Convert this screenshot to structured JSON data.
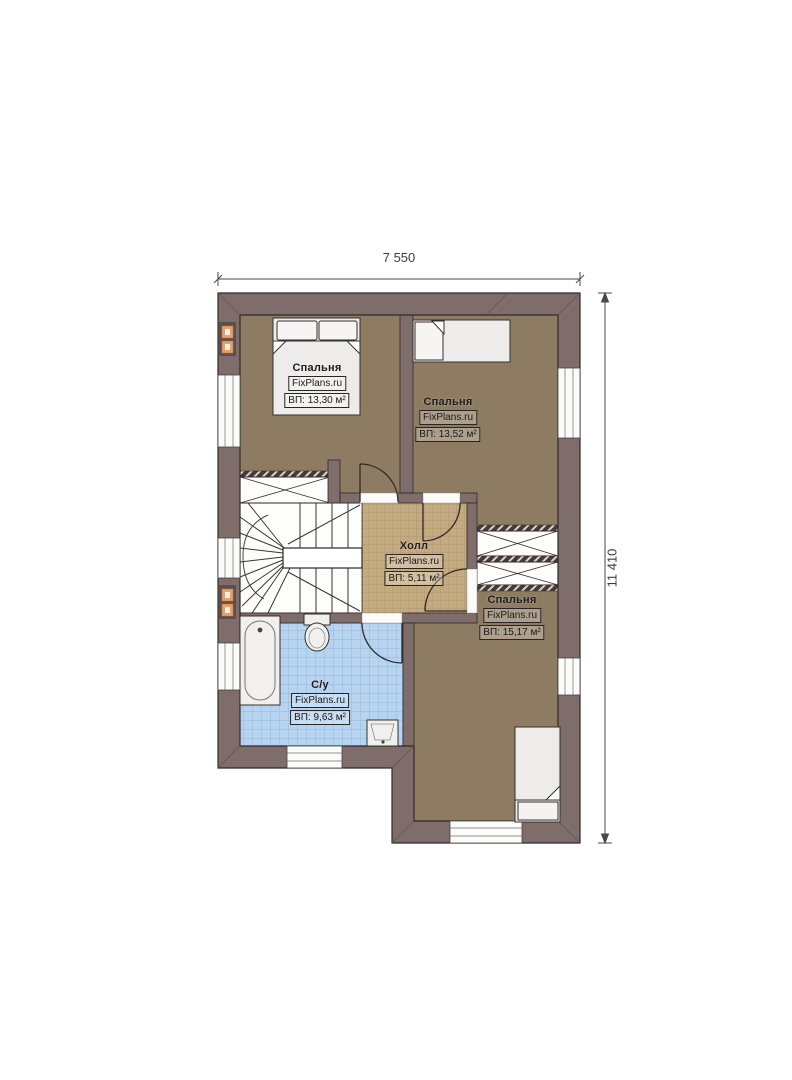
{
  "dimensions": {
    "top": "7 550",
    "right": "11 410"
  },
  "watermark": "FixPlans.ru",
  "rooms": [
    {
      "id": "bedroom-1",
      "name": "Спальня",
      "watermark": "FixPlans.ru",
      "area": "ВП: 13,30 м²"
    },
    {
      "id": "bedroom-2",
      "name": "Спальня",
      "watermark": "FixPlans.ru",
      "area": "ВП: 13,52 м²"
    },
    {
      "id": "hall",
      "name": "Холл",
      "watermark": "FixPlans.ru",
      "area": "ВП: 5,11 м²"
    },
    {
      "id": "bedroom-3",
      "name": "Спальня",
      "watermark": "FixPlans.ru",
      "area": "ВП: 15,17 м²"
    },
    {
      "id": "bathroom",
      "name": "С/у",
      "watermark": "FixPlans.ru",
      "area": "ВП: 9,63 м²"
    }
  ],
  "colors": {
    "wall": "#7e6d6a",
    "floor_wood": "#8d7c61",
    "hall_tile": "#c4aa80",
    "bath_tile": "#b6d3ef",
    "vent_orange": "#ea9f66",
    "fixture_white": "#edecea"
  }
}
